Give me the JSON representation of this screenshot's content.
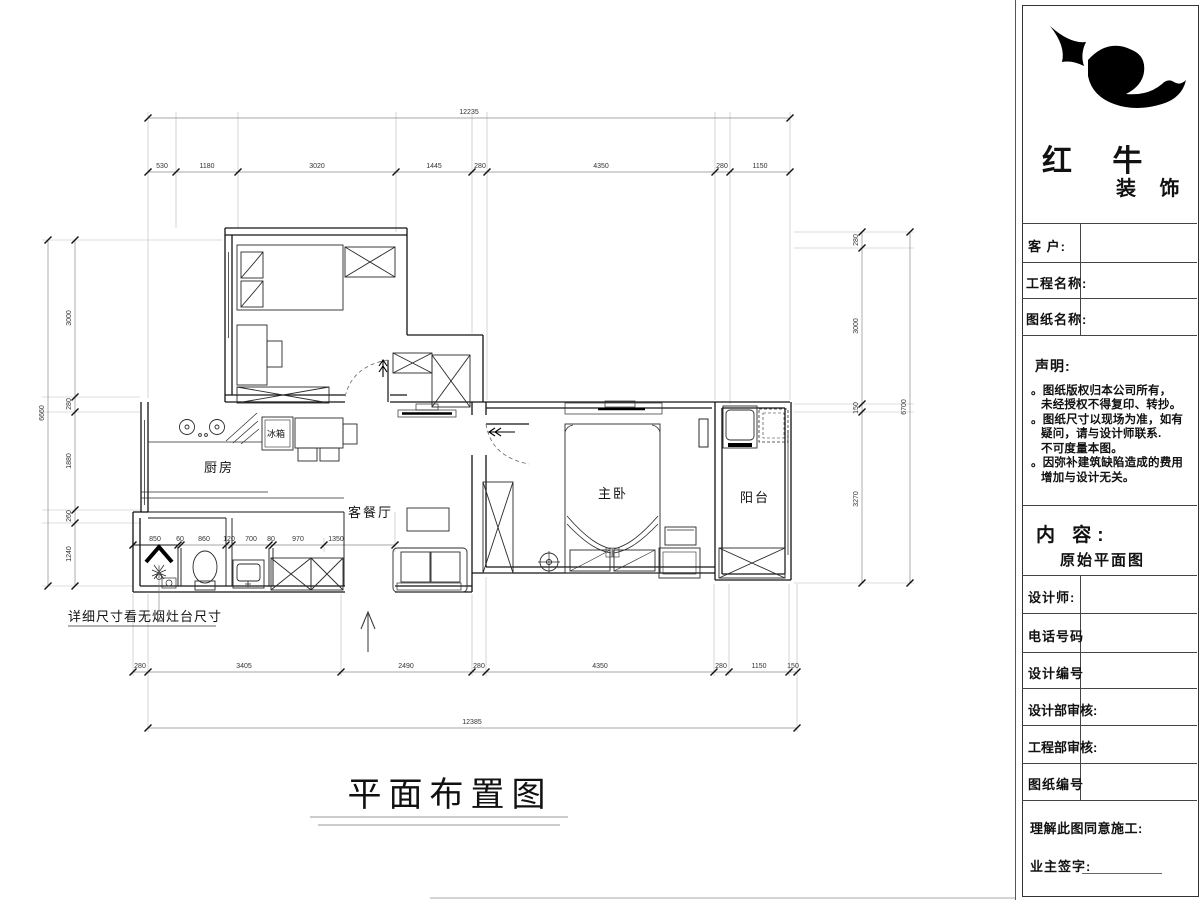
{
  "plan": {
    "title": "平面布置图",
    "note": "详细尺寸看无烟灶台尺寸",
    "rooms": {
      "kitchen": "厨房",
      "fridge": "冰箱",
      "living": "客餐厅",
      "master": "主卧",
      "balcony": "阳台"
    },
    "dims": {
      "top_total": "12235",
      "top": [
        "530",
        "1180",
        "3020",
        "1445",
        "280",
        "4350",
        "280",
        "1150"
      ],
      "mid": [
        "850",
        "60",
        "860",
        "120",
        "700",
        "80",
        "970",
        "1350"
      ],
      "bottom": [
        "280",
        "3405",
        "2490",
        "280",
        "4350",
        "280",
        "1150",
        "150"
      ],
      "bottom_total": "12385",
      "left_total": "6660",
      "left": [
        "3000",
        "280",
        "1880",
        "260",
        "1240"
      ],
      "right": [
        "280",
        "3000",
        "150",
        "3270"
      ],
      "right_total": "6700"
    }
  },
  "title_block": {
    "brand": {
      "name_main": "红 牛",
      "name_sub": "装 饰"
    },
    "customer_label": "客  户:",
    "project_label": "工程名称:",
    "sheet_label": "图纸名称:",
    "statement": {
      "heading": "声明:",
      "lines": [
        "。图纸版权归本公司所有，",
        "未经授权不得复印、转抄。",
        "。图纸尺寸以现场为准，如有",
        "疑问，请与设计师联系.",
        "不可度量本图。",
        "。因弥补建筑缺陷造成的费用",
        "增加与设计无关。"
      ]
    },
    "content": {
      "heading": "内 容:",
      "value": "原始平面图"
    },
    "rows": [
      "设计师:",
      "电话号码",
      "设计编号",
      "设计部审核:",
      "工程部审核:",
      "图纸编号"
    ],
    "footer": {
      "agree": "理解此图同意施工:",
      "sign": "业主签字:"
    }
  }
}
